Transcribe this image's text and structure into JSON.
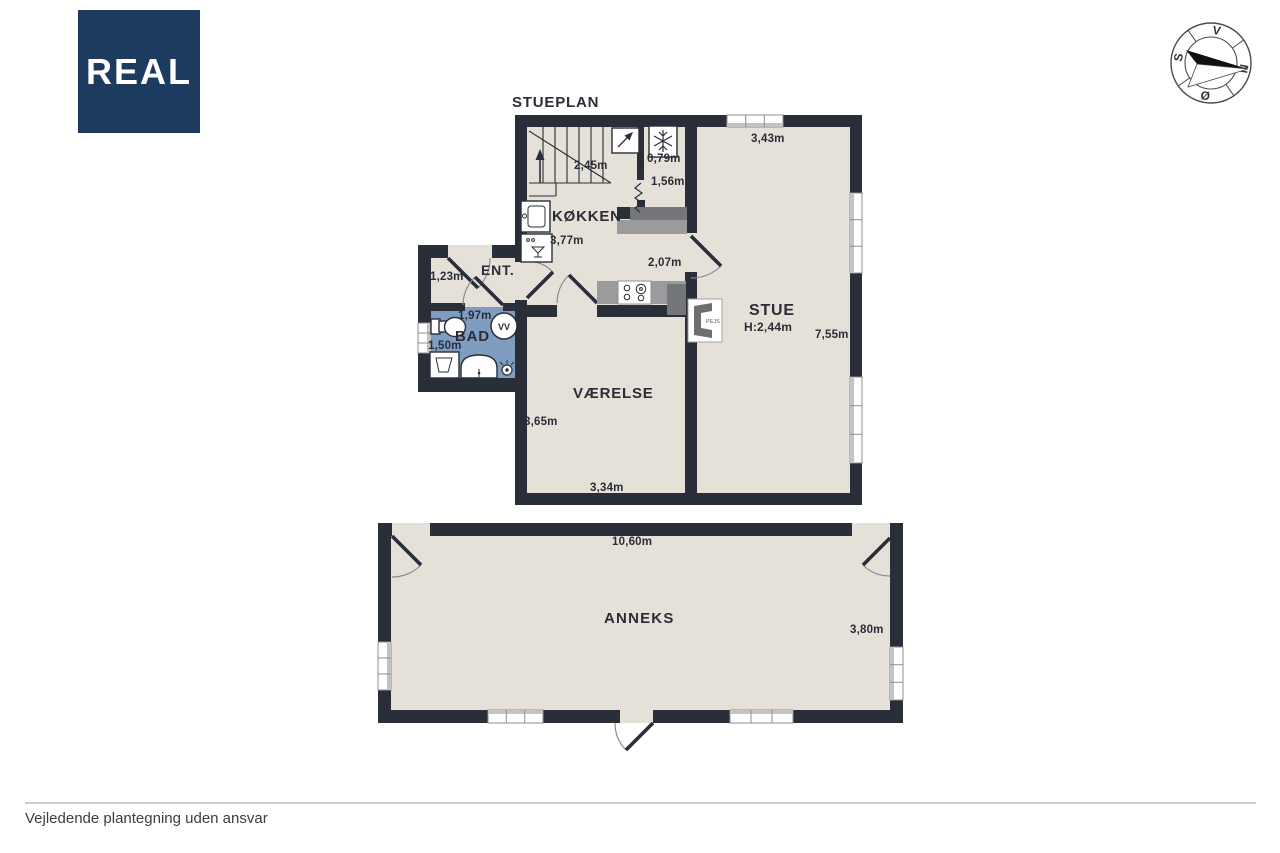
{
  "brand": {
    "logo_text": "REAL"
  },
  "plan": {
    "title": "STUEPLAN",
    "rooms": {
      "koekken": "KØKKEN",
      "stue": "STUE",
      "ent": "ENT.",
      "bad": "BAD",
      "vaerelse": "VÆRELSE"
    },
    "measurements": {
      "stair_width": "2,45m",
      "nook_width": "0,79m",
      "nook_depth": "1,56m",
      "koekken_width": "3,77m",
      "koekken_opening": "2,07m",
      "stue_width": "3,43m",
      "stue_ceiling": "H:2,44m",
      "stue_length": "7,55m",
      "ent_width": "1,23m",
      "bad_width": "1,97m",
      "bad_depth": "1,50m",
      "vaerelse_depth": "3,65m",
      "vaerelse_width": "3,34m"
    },
    "icons": {
      "water_heater": "VV",
      "fireplace": "PEJS"
    }
  },
  "anneks": {
    "name": "ANNEKS",
    "width": "10,60m",
    "depth": "3,80m"
  },
  "compass": {
    "north": "N",
    "east": "Ø",
    "south": "S",
    "west": "V"
  },
  "footer": {
    "disclaimer": "Vejledende plantegning uden ansvar"
  },
  "colors": {
    "wall": "#2a2e38",
    "floor": "#e6e1d8",
    "bad": "#7f9cc1",
    "counter": "#9b9b9d",
    "counter_dark": "#75767a",
    "window": "#c3c3c3",
    "outline": "#8f8f8f",
    "arc": "#8a8a8a",
    "text": "#2a2d37",
    "logo_bg": "#1d3b5f",
    "footer_line": "#cccccc"
  }
}
